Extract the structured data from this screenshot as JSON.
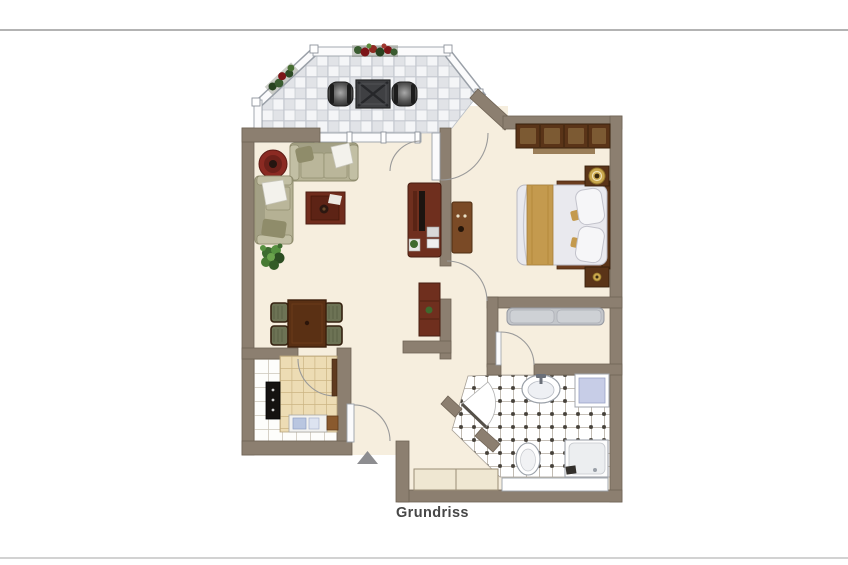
{
  "page": {
    "caption": "Grundriss"
  },
  "plan": {
    "type": "floor-plan",
    "rooms": [
      {
        "name": "balcony",
        "features": [
          "checkered-tile-floor",
          "white-railing",
          "flower-box-top",
          "flower-box-left",
          "chair-left",
          "chair-right",
          "bistro-table"
        ]
      },
      {
        "name": "living-dining-room",
        "features": [
          "round-rug",
          "sofa-horizontal",
          "sofa-vertical",
          "coffee-table",
          "potted-plant",
          "tv-cabinet",
          "red-sideboard",
          "dining-table",
          "four-dining-chairs"
        ]
      },
      {
        "name": "bedroom",
        "features": [
          "wardrobe",
          "double-bed",
          "gold-runner",
          "two-pillows",
          "nightstand-top-with-lamp",
          "nightstand-bottom"
        ]
      },
      {
        "name": "hallway",
        "features": [
          "wood-cabinet",
          "gray-bench",
          "built-in-closet",
          "entrance-arrow",
          "entrance-door"
        ]
      },
      {
        "name": "bathroom",
        "features": [
          "dot-tiled-floor",
          "washbasin",
          "washing-machine",
          "toilet",
          "shower",
          "window"
        ]
      },
      {
        "name": "kitchen",
        "features": [
          "white-tiled-floor",
          "tiled-counter",
          "stove",
          "sink",
          "cutting-board"
        ]
      }
    ]
  },
  "colors": {
    "wall": "#8c7f70",
    "wall_edge": "#6f6355",
    "floor": "#f6eede",
    "balcony_tile": "#e1e3e7",
    "wood_dark": "#5a3418",
    "wood_red": "#6f2f1e",
    "wood_light": "#7a4a26",
    "sofa": "#b5b194",
    "rug": "#8b2a22",
    "accent_gold": "#c49a4e",
    "washer_blue": "#c7cde7",
    "bench_gray": "#c3c6ca",
    "arrow_gray": "#8d8d90",
    "caption_text": "#474747",
    "divider": "#b3b3b3"
  }
}
